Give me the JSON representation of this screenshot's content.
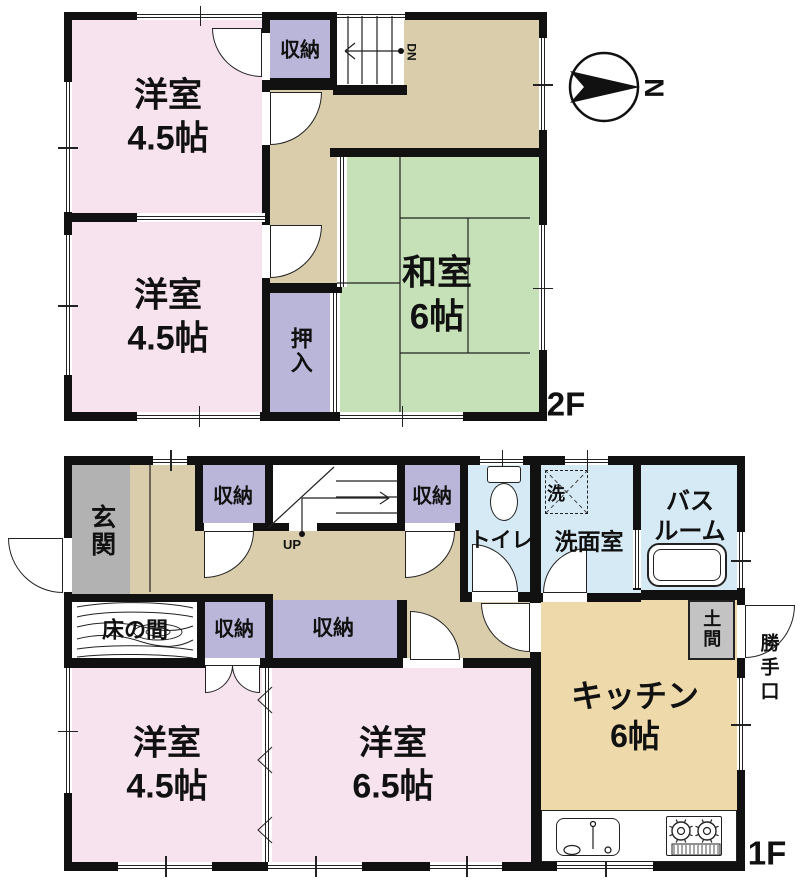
{
  "title": "2-story house floor plan",
  "floor_labels": {
    "upper": "2F",
    "lower": "1F"
  },
  "compass": {
    "label": "N",
    "cx": 604,
    "cy": 87,
    "r": 34,
    "dart": "570,71 640,87 570,103 584,87"
  },
  "stairs": {
    "down_label": "DN",
    "up_label": "UP"
  },
  "colors": {
    "pink": "#f7e3ee",
    "green": "#c6e0b7",
    "tan": "#d9cdab",
    "kitchen": "#eed9aa",
    "purple": "#bab6d9",
    "blue": "#d6eaf5",
    "gray": "#b2b2b2",
    "doma": "#c3c3c3",
    "wall": "#111111",
    "line": "#222222",
    "white": "#ffffff"
  },
  "rooms_summary": [
    {
      "floor": "2F",
      "name": "western-room-1",
      "label": "洋室\n4.5帖"
    },
    {
      "floor": "2F",
      "name": "western-room-2",
      "label": "洋室\n4.5帖"
    },
    {
      "floor": "2F",
      "name": "japanese-room",
      "label": "和室\n6帖"
    },
    {
      "floor": "2F",
      "name": "closet",
      "label": "収納"
    },
    {
      "floor": "2F",
      "name": "oshiire",
      "label": "押入"
    },
    {
      "floor": "1F",
      "name": "entrance",
      "label": "玄関"
    },
    {
      "floor": "1F",
      "name": "closet-1",
      "label": "収納"
    },
    {
      "floor": "1F",
      "name": "closet-2",
      "label": "収納"
    },
    {
      "floor": "1F",
      "name": "toilet",
      "label": "トイレ"
    },
    {
      "floor": "1F",
      "name": "laundry",
      "label": "洗"
    },
    {
      "floor": "1F",
      "name": "washroom",
      "label": "洗面室"
    },
    {
      "floor": "1F",
      "name": "bathroom",
      "label": "バス\nルーム"
    },
    {
      "floor": "1F",
      "name": "tokonoma",
      "label": "床の間"
    },
    {
      "floor": "1F",
      "name": "closet-3",
      "label": "収納"
    },
    {
      "floor": "1F",
      "name": "closet-4",
      "label": "収納"
    },
    {
      "floor": "1F",
      "name": "doma",
      "label": "土間"
    },
    {
      "floor": "1F",
      "name": "back-door",
      "label": "勝手口"
    },
    {
      "floor": "1F",
      "name": "western-room-3",
      "label": "洋室\n4.5帖"
    },
    {
      "floor": "1F",
      "name": "western-room-4",
      "label": "洋室\n6.5帖"
    },
    {
      "floor": "1F",
      "name": "kitchen",
      "label": "キッチン\n6帖"
    }
  ],
  "fills": [
    {
      "name": "room2f-1",
      "x": 72,
      "y": 20,
      "w": 195,
      "h": 197,
      "c": "pink"
    },
    {
      "name": "room2f-2",
      "x": 72,
      "y": 217,
      "w": 195,
      "h": 195,
      "c": "pink"
    },
    {
      "name": "hall2f-a",
      "x": 265,
      "y": 20,
      "w": 274,
      "h": 137,
      "c": "tan"
    },
    {
      "name": "hall2f-b",
      "x": 265,
      "y": 157,
      "w": 75,
      "h": 136,
      "c": "tan"
    },
    {
      "name": "washitsu",
      "x": 337,
      "y": 157,
      "w": 202,
      "h": 255,
      "c": "green"
    },
    {
      "name": "closet2f",
      "x": 267,
      "y": 20,
      "w": 66,
      "h": 60,
      "c": "purple"
    },
    {
      "name": "stairs2f",
      "x": 336,
      "y": 14,
      "w": 68,
      "h": 72,
      "c": "white"
    },
    {
      "name": "oshiire",
      "x": 267,
      "y": 290,
      "w": 66,
      "h": 122,
      "c": "purple"
    },
    {
      "name": "hall1f-a",
      "x": 128,
      "y": 465,
      "w": 340,
      "h": 137,
      "c": "tan"
    },
    {
      "name": "genkan",
      "x": 72,
      "y": 465,
      "w": 58,
      "h": 129,
      "c": "gray"
    },
    {
      "name": "tokonoma",
      "x": 72,
      "y": 600,
      "w": 125,
      "h": 62,
      "c": "white"
    },
    {
      "name": "closet1f-1",
      "x": 197,
      "y": 465,
      "w": 68,
      "h": 62,
      "c": "purple"
    },
    {
      "name": "stairs1f",
      "x": 265,
      "y": 465,
      "w": 135,
      "h": 64,
      "c": "white"
    },
    {
      "name": "closet1f-2",
      "x": 400,
      "y": 465,
      "w": 65,
      "h": 62,
      "c": "purple"
    },
    {
      "name": "hall1f-b",
      "x": 400,
      "y": 528,
      "w": 141,
      "h": 137,
      "c": "tan"
    },
    {
      "name": "toilet-room",
      "x": 465,
      "y": 465,
      "w": 70,
      "h": 137,
      "c": "blue"
    },
    {
      "name": "washroom",
      "x": 535,
      "y": 465,
      "w": 103,
      "h": 137,
      "c": "blue"
    },
    {
      "name": "bathroom",
      "x": 638,
      "y": 465,
      "w": 107,
      "h": 135,
      "c": "blue"
    },
    {
      "name": "closet1f-3",
      "x": 200,
      "y": 600,
      "w": 68,
      "h": 62,
      "c": "purple"
    },
    {
      "name": "closet1f-4",
      "x": 268,
      "y": 600,
      "w": 132,
      "h": 60,
      "c": "purple"
    },
    {
      "name": "room1f-1",
      "x": 72,
      "y": 665,
      "w": 195,
      "h": 197,
      "c": "pink"
    },
    {
      "name": "room1f-2",
      "x": 267,
      "y": 665,
      "w": 270,
      "h": 197,
      "c": "pink"
    },
    {
      "name": "kitchen",
      "x": 537,
      "y": 600,
      "w": 200,
      "h": 262,
      "c": "kitchen"
    }
  ],
  "walls": [
    {
      "x": 64,
      "y": 12,
      "w": 483,
      "h": 8
    },
    {
      "x": 64,
      "y": 412,
      "w": 483,
      "h": 9
    },
    {
      "x": 64,
      "y": 12,
      "w": 8,
      "h": 409
    },
    {
      "x": 539,
      "y": 12,
      "w": 8,
      "h": 409
    },
    {
      "x": 262,
      "y": 20,
      "w": 8,
      "h": 394
    },
    {
      "x": 72,
      "y": 213,
      "w": 193,
      "h": 9
    },
    {
      "x": 262,
      "y": 78,
      "w": 75,
      "h": 12
    },
    {
      "x": 330,
      "y": 12,
      "w": 7,
      "h": 78
    },
    {
      "x": 333,
      "y": 85,
      "w": 74,
      "h": 10
    },
    {
      "x": 330,
      "y": 148,
      "w": 209,
      "h": 9
    },
    {
      "x": 262,
      "y": 283,
      "w": 80,
      "h": 10
    },
    {
      "x": 64,
      "y": 456,
      "w": 681,
      "h": 9
    },
    {
      "x": 64,
      "y": 862,
      "w": 681,
      "h": 9
    },
    {
      "x": 64,
      "y": 456,
      "w": 8,
      "h": 415
    },
    {
      "x": 737,
      "y": 456,
      "w": 8,
      "h": 415
    },
    {
      "x": 64,
      "y": 594,
      "w": 209,
      "h": 8
    },
    {
      "x": 197,
      "y": 600,
      "w": 8,
      "h": 62
    },
    {
      "x": 195,
      "y": 465,
      "w": 8,
      "h": 63
    },
    {
      "x": 265,
      "y": 465,
      "w": 8,
      "h": 63
    },
    {
      "x": 195,
      "y": 523,
      "w": 273,
      "h": 8
    },
    {
      "x": 397,
      "y": 465,
      "w": 8,
      "h": 66
    },
    {
      "x": 460,
      "y": 465,
      "w": 8,
      "h": 137
    },
    {
      "x": 530,
      "y": 465,
      "w": 11,
      "h": 137
    },
    {
      "x": 530,
      "y": 600,
      "w": 11,
      "h": 65
    },
    {
      "x": 460,
      "y": 592,
      "w": 81,
      "h": 10
    },
    {
      "x": 541,
      "y": 593,
      "w": 100,
      "h": 9
    },
    {
      "x": 633,
      "y": 465,
      "w": 8,
      "h": 125
    },
    {
      "x": 641,
      "y": 590,
      "w": 104,
      "h": 10
    },
    {
      "x": 265,
      "y": 600,
      "w": 8,
      "h": 62
    },
    {
      "x": 397,
      "y": 600,
      "w": 10,
      "h": 65
    },
    {
      "x": 64,
      "y": 658,
      "w": 209,
      "h": 10
    },
    {
      "x": 265,
      "y": 658,
      "w": 276,
      "h": 10
    },
    {
      "x": 531,
      "y": 655,
      "w": 10,
      "h": 207
    }
  ],
  "gaps": [
    {
      "x": 262,
      "y": 33,
      "w": 8,
      "h": 47
    },
    {
      "x": 262,
      "y": 92,
      "w": 8,
      "h": 53
    },
    {
      "x": 262,
      "y": 225,
      "w": 8,
      "h": 53
    },
    {
      "x": 204,
      "y": 523,
      "w": 49,
      "h": 8
    },
    {
      "x": 289,
      "y": 523,
      "w": 28,
      "h": 8
    },
    {
      "x": 405,
      "y": 523,
      "w": 50,
      "h": 8
    },
    {
      "x": 472,
      "y": 592,
      "w": 46,
      "h": 10
    },
    {
      "x": 543,
      "y": 593,
      "w": 44,
      "h": 9
    },
    {
      "x": 530,
      "y": 603,
      "w": 11,
      "h": 49
    },
    {
      "x": 205,
      "y": 658,
      "w": 55,
      "h": 10
    },
    {
      "x": 403,
      "y": 658,
      "w": 60,
      "h": 10
    },
    {
      "x": 64,
      "y": 538,
      "w": 8,
      "h": 54
    },
    {
      "x": 737,
      "y": 605,
      "w": 8,
      "h": 53
    }
  ],
  "windows": [
    {
      "x": 137,
      "y": 12,
      "w": 125,
      "h": 8,
      "o": "h",
      "tick": true
    },
    {
      "x": 337,
      "y": 12,
      "w": 68,
      "h": 8,
      "o": "h",
      "tick": false
    },
    {
      "x": 64,
      "y": 82,
      "w": 8,
      "h": 130,
      "o": "v",
      "tick": true
    },
    {
      "x": 64,
      "y": 235,
      "w": 8,
      "h": 140,
      "o": "v",
      "tick": true
    },
    {
      "x": 137,
      "y": 412,
      "w": 123,
      "h": 9,
      "o": "h",
      "tick": true
    },
    {
      "x": 340,
      "y": 412,
      "w": 123,
      "h": 9,
      "o": "h",
      "tick": true
    },
    {
      "x": 539,
      "y": 38,
      "w": 8,
      "h": 92,
      "o": "v",
      "tick": true
    },
    {
      "x": 539,
      "y": 225,
      "w": 8,
      "h": 125,
      "o": "v",
      "tick": true
    },
    {
      "x": 153,
      "y": 456,
      "w": 34,
      "h": 9,
      "o": "h",
      "tick": true
    },
    {
      "x": 480,
      "y": 456,
      "w": 43,
      "h": 9,
      "o": "h",
      "tick": true
    },
    {
      "x": 565,
      "y": 456,
      "w": 43,
      "h": 9,
      "o": "h",
      "tick": true
    },
    {
      "x": 64,
      "y": 668,
      "w": 8,
      "h": 125,
      "o": "v",
      "tick": true
    },
    {
      "x": 118,
      "y": 862,
      "w": 94,
      "h": 9,
      "o": "h",
      "tick": true
    },
    {
      "x": 268,
      "y": 862,
      "w": 94,
      "h": 9,
      "o": "h",
      "tick": true
    },
    {
      "x": 430,
      "y": 862,
      "w": 72,
      "h": 9,
      "o": "h",
      "tick": true
    },
    {
      "x": 557,
      "y": 862,
      "w": 96,
      "h": 9,
      "o": "h",
      "tick": true
    },
    {
      "x": 737,
      "y": 532,
      "w": 8,
      "h": 56,
      "o": "v",
      "tick": true
    },
    {
      "x": 737,
      "y": 678,
      "w": 8,
      "h": 92,
      "o": "v",
      "tick": true
    }
  ],
  "sliders": [
    {
      "x": 137,
      "y": 213,
      "w": 128,
      "h": 9,
      "o": "h"
    },
    {
      "x": 337,
      "y": 157,
      "w": 10,
      "h": 130,
      "o": "v"
    },
    {
      "x": 330,
      "y": 293,
      "w": 10,
      "h": 119,
      "o": "v"
    },
    {
      "x": 633,
      "y": 530,
      "w": 8,
      "h": 58,
      "o": "v"
    },
    {
      "x": 262,
      "y": 668,
      "w": 10,
      "h": 194,
      "o": "v"
    }
  ],
  "doors": [
    {
      "name": "closet2f-door",
      "x": 212,
      "y": 28,
      "w": 50,
      "h": 49,
      "p": "tr"
    },
    {
      "name": "room2f1-door",
      "x": 270,
      "y": 92,
      "w": 52,
      "h": 53,
      "p": "tl"
    },
    {
      "name": "room2f2-door",
      "x": 270,
      "y": 225,
      "w": 52,
      "h": 53,
      "p": "tl"
    },
    {
      "name": "front-door",
      "x": 8,
      "y": 538,
      "w": 55,
      "h": 55,
      "p": "tr"
    },
    {
      "name": "closet1f1-door",
      "x": 204,
      "y": 531,
      "w": 50,
      "h": 47,
      "p": "tl"
    },
    {
      "name": "closet1f2-door",
      "x": 405,
      "y": 531,
      "w": 50,
      "h": 47,
      "p": "tl"
    },
    {
      "name": "toilet-door",
      "x": 472,
      "y": 544,
      "w": 46,
      "h": 48,
      "p": "bl"
    },
    {
      "name": "washroom-door",
      "x": 543,
      "y": 548,
      "w": 44,
      "h": 45,
      "p": "br"
    },
    {
      "name": "kitchen-door",
      "x": 481,
      "y": 603,
      "w": 49,
      "h": 49,
      "p": "tr"
    },
    {
      "name": "room1f2-door",
      "x": 410,
      "y": 611,
      "w": 50,
      "h": 49,
      "p": "bl"
    },
    {
      "name": "back-door",
      "x": 745,
      "y": 605,
      "w": 50,
      "h": 53,
      "p": "tl"
    },
    {
      "name": "closet1f3-door-l",
      "x": 205,
      "y": 665,
      "w": 28,
      "h": 28,
      "p": "tl"
    },
    {
      "name": "closet1f3-door-r",
      "x": 232,
      "y": 665,
      "w": 28,
      "h": 28,
      "p": "tr"
    }
  ],
  "boxes": [
    {
      "name": "kitchen-counter",
      "x": 541,
      "y": 810,
      "w": 196,
      "h": 52,
      "r": 0,
      "bw": 1.5,
      "fill": "#ffffff"
    },
    {
      "name": "sink",
      "x": 556,
      "y": 818,
      "w": 64,
      "h": 38,
      "r": 8,
      "bw": 1.5,
      "fill": "#ffffff"
    },
    {
      "name": "stove",
      "x": 666,
      "y": 816,
      "w": 56,
      "h": 40,
      "r": 2,
      "bw": 1.5,
      "fill": "#ffffff"
    },
    {
      "name": "bathtub",
      "x": 647,
      "y": 543,
      "w": 80,
      "h": 44,
      "r": 12,
      "bw": 2,
      "fill": "#ffffff"
    },
    {
      "name": "bathtub-inner",
      "x": 653,
      "y": 549,
      "w": 68,
      "h": 32,
      "r": 8,
      "bw": 1,
      "fill": "none"
    },
    {
      "name": "toilet-tank",
      "x": 487,
      "y": 466,
      "w": 34,
      "h": 17,
      "r": 3,
      "bw": 1.5,
      "fill": "#ffffff"
    },
    {
      "name": "doma",
      "x": 688,
      "y": 600,
      "w": 47,
      "h": 60,
      "r": 0,
      "bw": 2,
      "fill": "#c3c3c3"
    },
    {
      "name": "laundry-box",
      "x": 545,
      "y": 470,
      "w": 43,
      "h": 44,
      "r": 0,
      "bw": 1,
      "fill": "none",
      "dashed": true
    }
  ],
  "ellipses": [
    {
      "name": "toilet-bowl",
      "cx": 504,
      "cy": 502,
      "rx": 14,
      "ry": 19,
      "bw": 1.5,
      "fill": "#ffffff"
    }
  ],
  "labels": [
    {
      "name": "room2f-1-label",
      "t": "洋室\n4.5帖",
      "x": 168,
      "y": 117,
      "s": 34
    },
    {
      "name": "room2f-2-label",
      "t": "洋室\n4.5帖",
      "x": 168,
      "y": 317,
      "s": 34
    },
    {
      "name": "closet2f-label",
      "t": "収納",
      "x": 300,
      "y": 51,
      "s": 20
    },
    {
      "name": "oshiire-label",
      "t": "押入",
      "x": 300,
      "y": 351,
      "s": 22,
      "vert": true
    },
    {
      "name": "washitsu-label",
      "t": "和室\n6帖",
      "x": 437,
      "y": 295,
      "s": 35
    },
    {
      "name": "floor2-label",
      "t": "2F",
      "x": 566,
      "y": 404,
      "s": 33
    },
    {
      "name": "dn-label",
      "t": "DN",
      "x": 411,
      "y": 52,
      "s": 12,
      "rot": true
    },
    {
      "name": "north-label",
      "t": "N",
      "x": 653,
      "y": 88,
      "s": 27,
      "rot": true,
      "bold": true
    },
    {
      "name": "genkan-label",
      "t": "玄関",
      "x": 101,
      "y": 531,
      "s": 25,
      "vert": true
    },
    {
      "name": "closet1f-1-label",
      "t": "収納",
      "x": 233,
      "y": 497,
      "s": 20
    },
    {
      "name": "closet1f-2-label",
      "t": "収納",
      "x": 432,
      "y": 497,
      "s": 20
    },
    {
      "name": "up-label",
      "t": "UP",
      "x": 292,
      "y": 545,
      "s": 13
    },
    {
      "name": "toilet-label",
      "t": "トイレ",
      "x": 501,
      "y": 541,
      "s": 21
    },
    {
      "name": "laundry-label",
      "t": "洗",
      "x": 556,
      "y": 494,
      "s": 18
    },
    {
      "name": "washroom-label",
      "t": "洗面室",
      "x": 589,
      "y": 542,
      "s": 23
    },
    {
      "name": "bathroom-label",
      "t": "バス\nルーム",
      "x": 690,
      "y": 517,
      "s": 24
    },
    {
      "name": "tokonoma-label",
      "t": "床の間",
      "x": 135,
      "y": 630,
      "s": 22
    },
    {
      "name": "closet1f-3-label",
      "t": "収納",
      "x": 234,
      "y": 630,
      "s": 20
    },
    {
      "name": "closet1f-4-label",
      "t": "収納",
      "x": 333,
      "y": 629,
      "s": 21
    },
    {
      "name": "doma-label",
      "t": "土間",
      "x": 711,
      "y": 629,
      "s": 18,
      "vert": true
    },
    {
      "name": "backdoor-label",
      "t": "勝手口",
      "x": 770,
      "y": 668,
      "s": 19
    },
    {
      "name": "room1f-1-label",
      "t": "洋室\n4.5帖",
      "x": 167,
      "y": 765,
      "s": 34
    },
    {
      "name": "room1f-2-label",
      "t": "洋室\n6.5帖",
      "x": 393,
      "y": 765,
      "s": 34
    },
    {
      "name": "kitchen-label",
      "t": "キッチン\n6帖",
      "x": 635,
      "y": 716,
      "s": 32
    },
    {
      "name": "floor1-label",
      "t": "1F",
      "x": 767,
      "y": 853,
      "s": 33
    }
  ],
  "svg": {
    "lines": [
      [
        348,
        16,
        348,
        84
      ],
      [
        362,
        16,
        362,
        84
      ],
      [
        377,
        16,
        377,
        84
      ],
      [
        392,
        16,
        392,
        84
      ],
      [
        345,
        51,
        399,
        51
      ],
      [
        345,
        51,
        355,
        43
      ],
      [
        345,
        51,
        355,
        59
      ],
      [
        268,
        528,
        334,
        467
      ],
      [
        336,
        481,
        398,
        481
      ],
      [
        336,
        497,
        398,
        497
      ],
      [
        336,
        513,
        398,
        513
      ],
      [
        302,
        534,
        302,
        498
      ],
      [
        302,
        498,
        389,
        498
      ],
      [
        389,
        498,
        380,
        492
      ],
      [
        389,
        498,
        380,
        504
      ],
      [
        150,
        465,
        150,
        592
      ],
      [
        400,
        157,
        400,
        412
      ],
      [
        400,
        218,
        530,
        218
      ],
      [
        468,
        218,
        468,
        353
      ],
      [
        400,
        353,
        530,
        353
      ],
      [
        337,
        283,
        400,
        283
      ],
      [
        593,
        826,
        593,
        849
      ]
    ],
    "dashed_lines": [
      [
        545,
        470,
        588,
        514
      ],
      [
        588,
        470,
        545,
        514
      ]
    ],
    "dots": [
      [
        401,
        51
      ],
      [
        302,
        534
      ]
    ],
    "circles": [
      {
        "cx": 604,
        "cy": 87,
        "r": 34,
        "sw": 2.5
      },
      {
        "cx": 593,
        "cy": 824,
        "r": 2.5,
        "sw": 1.2
      },
      {
        "cx": 608,
        "cy": 850,
        "r": 3,
        "sw": 1.2
      }
    ],
    "ellipses": [
      {
        "cx": 572,
        "cy": 850,
        "rx": 8,
        "ry": 4.5,
        "sw": 1.2
      },
      {
        "cx": 158,
        "cy": 632,
        "rx": 24,
        "ry": 8,
        "sw": 0.9
      },
      {
        "cx": 158,
        "cy": 632,
        "rx": 12,
        "ry": 4,
        "sw": 0.9
      }
    ],
    "burners": [
      {
        "cx": 681,
        "cy": 831
      },
      {
        "cx": 707,
        "cy": 831
      }
    ],
    "hatch": {
      "x1": 674,
      "x2": 718,
      "step": 4,
      "y1": 845,
      "y2": 854
    },
    "polygon": "570,71 640,87 570,103 584,87",
    "paths": [
      "M77,607 C110,601 162,601 193,608",
      "M77,617 C105,610 165,611 193,617",
      "M77,627 C100,621 125,622 148,628 C165,632 180,631 193,626",
      "M77,639 C100,633 122,635 142,642 C165,649 180,647 193,640",
      "M77,649 C110,644 162,645 193,650",
      "M77,657 C110,653 162,654 193,658",
      "M272,687 L258,700 L272,713",
      "M272,747 L258,760 L272,773",
      "M272,817 L258,830 L272,843"
    ]
  }
}
